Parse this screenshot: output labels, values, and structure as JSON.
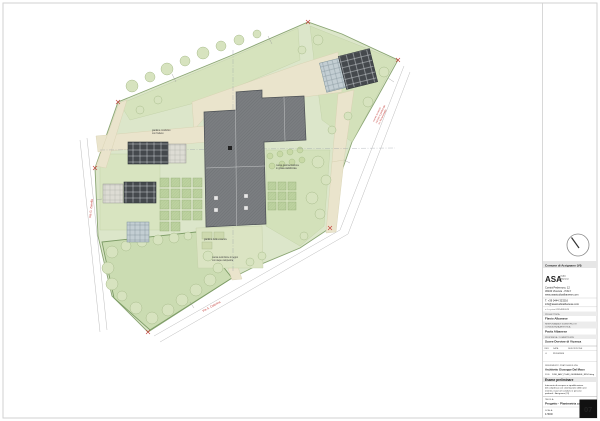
{
  "plan": {
    "labels": {
      "garden_top": [
        "giardino condiviso",
        "con frutteto"
      ],
      "paving": [
        "nuova pavimentazione",
        "in ghiaia stabilizzata"
      ],
      "south_garden": "giardino delle essenze",
      "fence": [
        "nuova recinzione in legno",
        "con siepe campestre"
      ]
    },
    "roads": {
      "left": "Via G. Zanella",
      "bottom": "Via S. Caterina",
      "right_note": [
        "nuovo accesso",
        "carraio e pedonale",
        "su Via Montello"
      ]
    }
  },
  "titleblock": {
    "municipality": "Comune di Arzignano (VI)",
    "firm": {
      "name": "ASA",
      "tag1": "studio",
      "tag2": "albanese",
      "address1": "Contrà Pedemuro, 12",
      "address2": "36100 Vicenza - ITALY",
      "website": "www.asastudioalbanese.com",
      "phone": "T. +39 0444 323216",
      "email": "info@asastudioalbanese.com",
      "vat": "c.f. e p.iva 02354890249"
    },
    "sections": [
      {
        "label": "PROGETTISTA",
        "value": "Flavio Albanese"
      },
      {
        "label": "RESPONSABILE SCIENTIFICO E",
        "label2": "CONSULENZA ARTISTICA",
        "value": "Paola Albanese"
      },
      {
        "label": "PROPRIETÀ / COMMITTENTE",
        "value": "Suore Dorotee di Vicenza"
      }
    ],
    "revisions": {
      "headers": [
        "REV.",
        "DATA",
        "DESCRIZIONE"
      ],
      "row": [
        "0",
        "21/10/2024",
        ""
      ]
    },
    "reference_label": "RIFERIMENTO PRATICA EDILIZIA",
    "reference_value": "Architetto Giuseppe Dal Maso",
    "file_label": "FILE:",
    "file_value": "2436_ARZ_PLAN_GENERALE_REV0.dwg",
    "phase": "Esame preliminare",
    "description": [
      "Intervento di recupero e riqualificazione",
      "del complesso con sistemazione delle aree",
      "esterne, nuovi orti condivisi e percorsi",
      "pedonali - Arzignano (VI)"
    ],
    "tavola_label": "TAVOLA:",
    "tavola_value": "Progetto - Planimetria coperture",
    "scala_label": "SCALA:",
    "scala_value": "1:500",
    "sheet_number": "07"
  },
  "colors": {
    "site_green": "#dce6ca",
    "lawn_green": "#d3e1ba",
    "field_green": "#cbdcb2",
    "paving_beige": "#eae4cc",
    "roof_gray": "#7b7e81",
    "solar_dark": "#45494d",
    "accent_red": "#c23b36"
  }
}
